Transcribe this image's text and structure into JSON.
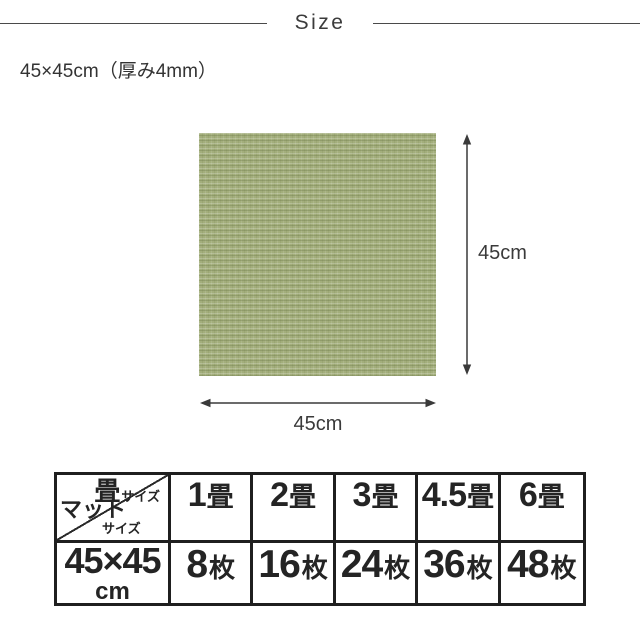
{
  "title": "Size",
  "subtitle": "45×45cm（厚み4mm）",
  "diagram": {
    "swatch_color": "#a3ae7c",
    "height_label": "45cm",
    "width_label": "45cm"
  },
  "table": {
    "corner": {
      "top_main": "畳",
      "top_sub": "サイズ",
      "bottom_main": "マット",
      "bottom_sub": "サイズ"
    },
    "mat_size": {
      "line1": "45×45",
      "line2": "cm"
    },
    "columns": [
      {
        "tatami_num": "1",
        "tatami_unit": "畳",
        "count_num": "8",
        "count_unit": "枚"
      },
      {
        "tatami_num": "2",
        "tatami_unit": "畳",
        "count_num": "16",
        "count_unit": "枚"
      },
      {
        "tatami_num": "3",
        "tatami_unit": "畳",
        "count_num": "24",
        "count_unit": "枚"
      },
      {
        "tatami_num": "4.5",
        "tatami_unit": "畳",
        "count_num": "36",
        "count_unit": "枚"
      },
      {
        "tatami_num": "6",
        "tatami_unit": "畳",
        "count_num": "48",
        "count_unit": "枚"
      }
    ]
  }
}
